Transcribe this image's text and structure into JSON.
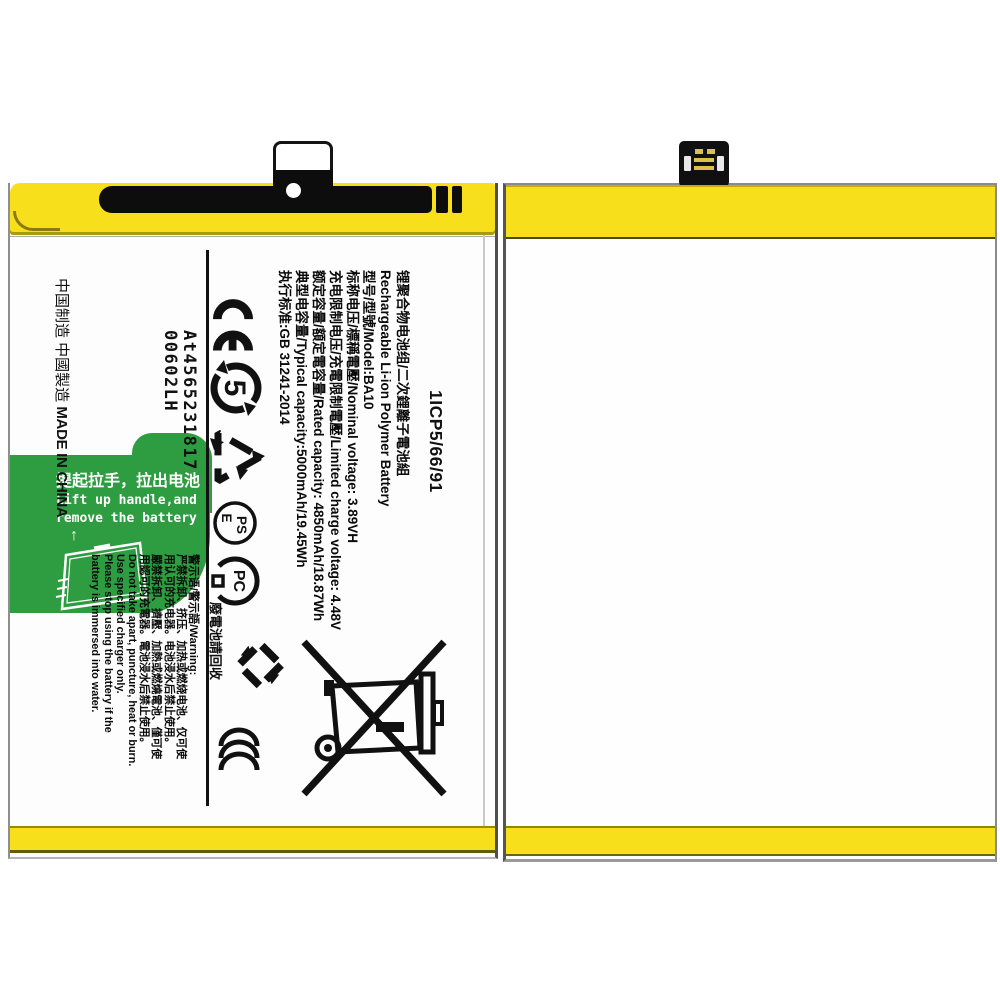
{
  "front": {
    "part_number": "1ICP5/66/91",
    "spec_lines": [
      "锂聚合物电池组/二次鋰離子電池組",
      "Rechargeable Li-ion Polymer Battery",
      "型号/型號/Model:BA10",
      "标称电压/標稱電壓/Nominal voltage: 3.89VH",
      "充电限制电压/充電限制電壓/Limited charge voltage: 4.48V",
      "额定容量/額定電容量/Rated capacity: 4850mAh/18.87Wh",
      "典型电容量/Typical capacity:5000mAh/19.45Wh",
      "执行标准:GB 31241-2014"
    ],
    "marks": {
      "efup_number": "5",
      "pse_top": "PS",
      "pse_bottom": "E",
      "pc_label": "PC",
      "recycle_caption": "廢電池請回收"
    },
    "serial": {
      "line1": "At4565231817",
      "line2": "00602LH"
    },
    "made_in": {
      "cn": "中国制造 中國製造",
      "en": "MADE IN CHINA"
    },
    "warning_lines": [
      "警示语/警示語/Warning:",
      "严禁拆卸、挤压、加热或燃烧电池、仅可使",
      "用认可的充电器。电池浸水后禁止使用。",
      "嚴禁拆卸、擠壓、加熱或燃燒電池、僅可使",
      "用認可的充電器。電池浸水后禁止使用。",
      "Do not take apart, puncture, heat or burn.",
      "Use specified charger only.",
      "Please stop using the battery if the",
      "battery is immersed into water."
    ],
    "pull_tab": {
      "cn": "提起拉手，拉出电池",
      "en1": "Lift up handle,and",
      "en2": "remove the battery",
      "arrow": "↑"
    }
  },
  "colors": {
    "label_yellow": "#f8df1c",
    "tab_green": "#2e9c40",
    "ink": "#111111"
  }
}
